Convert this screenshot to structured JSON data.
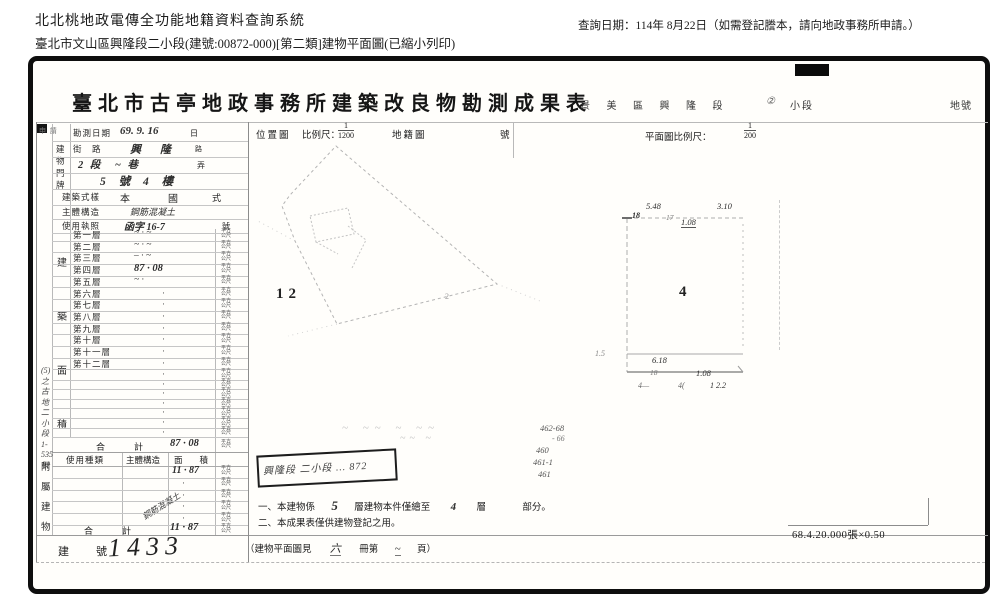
{
  "app": {
    "system_title": "北北桃地政電傳全功能地籍資料查詢系統",
    "subtitle": "臺北市文山區興隆段二小段(建號:00872-000)[第二類]建物平面圖(已縮小列印)",
    "query_date": "查詢日期：114年 8月22日（如需登記謄本，請向地政事務所申請。）"
  },
  "doc": {
    "title": "臺北市古亭地政事務所建築改良物勘測成果表",
    "district": "景 美 區 興 隆 段",
    "district_circle": "②",
    "district_small": "小段",
    "district_lot": "地號",
    "corner_note": "申 請",
    "dot": "·",
    "unit_area": "平方公尺",
    "rows": {
      "survey": {
        "label": "勘測日期",
        "value": "69. 9. 16",
        "unit": "日"
      },
      "plate_vertical": "建\n物\n門\n牌",
      "street": {
        "label": "街　路",
        "value": "興　隆",
        "unit": "路"
      },
      "section": {
        "value": "2 段　~ 巷",
        "unit": "弄"
      },
      "plate": {
        "value": "5 號 4 樓"
      },
      "style": {
        "label": "建築式樣",
        "value": "本　國",
        "unit": "式"
      },
      "structure": {
        "label": "主體構造",
        "value": "鋼筋混凝土"
      },
      "license": {
        "label": "使用執照",
        "value": "函字 16-7",
        "unit": "號"
      }
    },
    "area_vertical": "建\n築\n面\n積",
    "floors": [
      {
        "label": "第一層",
        "value": "~ · ~"
      },
      {
        "label": "第二層",
        "value": "~ · ~"
      },
      {
        "label": "第三層",
        "value": "– · ~"
      },
      {
        "label": "第四層",
        "value": "87 · 08"
      },
      {
        "label": "第五層",
        "value": "~ ·"
      },
      {
        "label": "第六層",
        "value": ""
      },
      {
        "label": "第七層",
        "value": ""
      },
      {
        "label": "第八層",
        "value": ""
      },
      {
        "label": "第九層",
        "value": ""
      },
      {
        "label": "第十層",
        "value": ""
      },
      {
        "label": "第十一層",
        "value": ""
      },
      {
        "label": "第十二層",
        "value": ""
      }
    ],
    "base_vertical": "(5)之\n古\n地\n二\n小\n段\n1-535\n號",
    "total": {
      "label": "合　計",
      "value": "87 · 08"
    },
    "annex": {
      "vertical": "附\n屬\n建\n物",
      "header": {
        "use": "使用種類",
        "structure": "主體構造",
        "area": "面　　積"
      },
      "diagonal": "鋼筋混凝土",
      "row1_value": "11 · 87",
      "total": {
        "label": "合　計",
        "value": "11 · 87"
      }
    },
    "building_no": {
      "label": "建　號",
      "value": "1433"
    }
  },
  "middle": {
    "header": {
      "left": "位置圖",
      "scale": "比例尺：",
      "num": "1",
      "den": "1200",
      "map": "地籍圖",
      "no": "號"
    },
    "sketch": {
      "lot": "12",
      "tiny": "2"
    },
    "stamp": "興隆段 二小段 … 872",
    "pencil1": "~ ~~  ~  ~~",
    "pencil2": "~~  ~",
    "numbers": [
      "462-68",
      "- 66",
      "460",
      "461-1",
      "461"
    ],
    "note1": {
      "a": "一、本建物係",
      "hw1": "5",
      "b": "層建物本件僅繪至",
      "hw2": "4",
      "c": "層",
      "d": "部分。"
    },
    "note2": "二、本成果表僅供建物登記之用。",
    "bottom": {
      "a": "（建物平面圖見",
      "hw1": "六",
      "b": "冊第",
      "hw2": "~",
      "c": "頁）"
    }
  },
  "plan": {
    "header": {
      "label": "平面圖比例尺：",
      "num": "1",
      "den": "200"
    },
    "floor": "4",
    "t1": "5.48",
    "t2": "3.10",
    "t3": "18",
    "t4": "17",
    "t5": "1.08",
    "l1": "1.5",
    "b1": "6.18",
    "b2": "18",
    "b3": "1.08",
    "b4": "4—",
    "b5": "4(",
    "b6": "1 2.2"
  },
  "footer": {
    "print_code": "68.4.20.000張×0.50"
  }
}
